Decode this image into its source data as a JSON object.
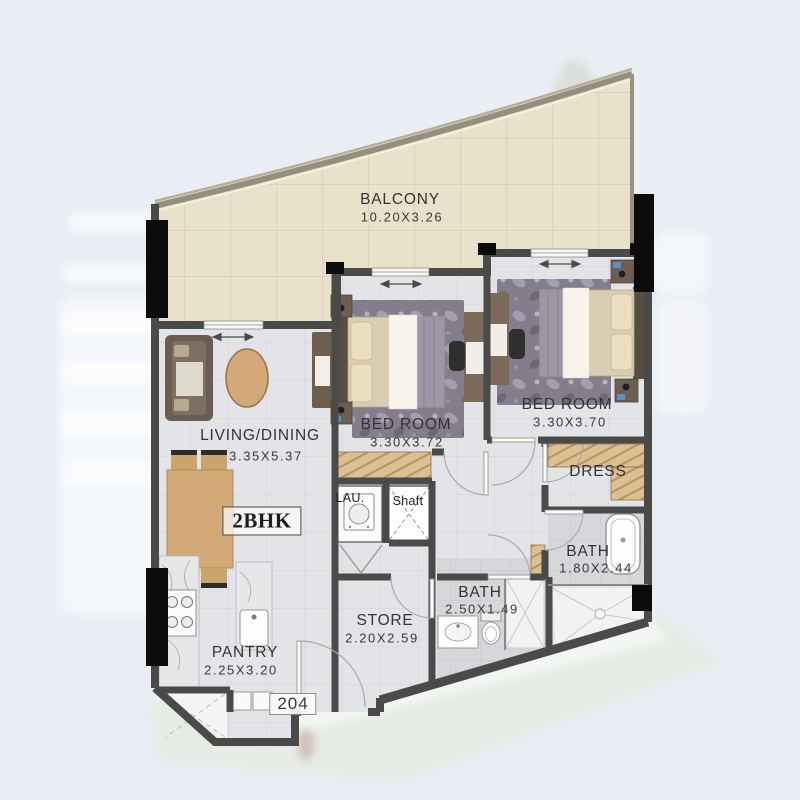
{
  "unit": {
    "type_label": "2BHK",
    "number": "204"
  },
  "rooms": {
    "balcony": {
      "name": "BALCONY",
      "dim": "10.20X3.26"
    },
    "living": {
      "name": "LIVING/DINING",
      "dim": "3.35X5.37"
    },
    "bedroom1": {
      "name": "BED ROOM",
      "dim": "3.30X3.72"
    },
    "bedroom2": {
      "name": "BED ROOM",
      "dim": "3.30X3.70"
    },
    "dress": {
      "name": "DRESS"
    },
    "bath1": {
      "name": "BATH",
      "dim": "1.80X2.44"
    },
    "bath2": {
      "name": "BATH",
      "dim": "2.50X1.49"
    },
    "store": {
      "name": "STORE",
      "dim": "2.20X2.59"
    },
    "pantry": {
      "name": "PANTRY",
      "dim": "2.25X3.20"
    },
    "laundry": {
      "name": "LAU."
    },
    "shaft": {
      "name": "Shaft"
    }
  },
  "colors": {
    "background": "#e9eef4",
    "balcony_floor": "#e9e1cb",
    "interior_floor": "#e3e4e7",
    "bath_floor": "#d7d7db",
    "wall": "#4a4a48",
    "column": "#0c0c0c",
    "wardrobe_wood": "#dcc094",
    "furniture_wood": "#d3a977",
    "sofa": "#6b5d52",
    "rug": "#847e8c",
    "accent_blue": "#5b8fc9"
  }
}
